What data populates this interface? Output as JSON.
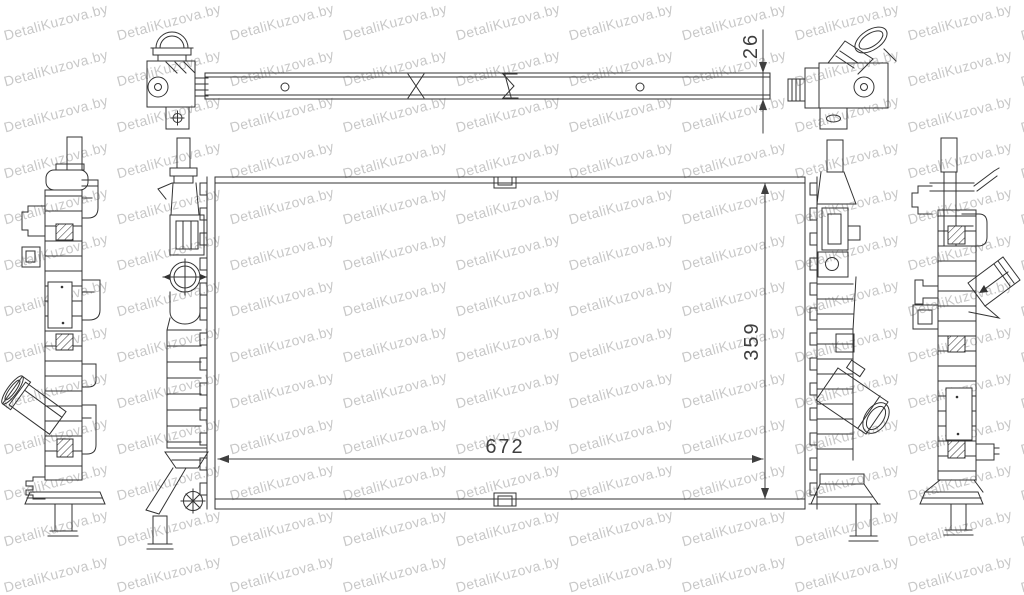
{
  "page": {
    "background": "#ffffff"
  },
  "watermark": {
    "text": "DetaliKuzova.by",
    "color": "#c8c8c8",
    "angle_deg": -15
  },
  "drawing": {
    "subject": "car-radiator-orthographic-technical-drawing",
    "line_color": "#333333",
    "dim_color": "#3f3f3f",
    "dimensions": {
      "thickness": "26",
      "height": "359",
      "width": "672"
    }
  }
}
